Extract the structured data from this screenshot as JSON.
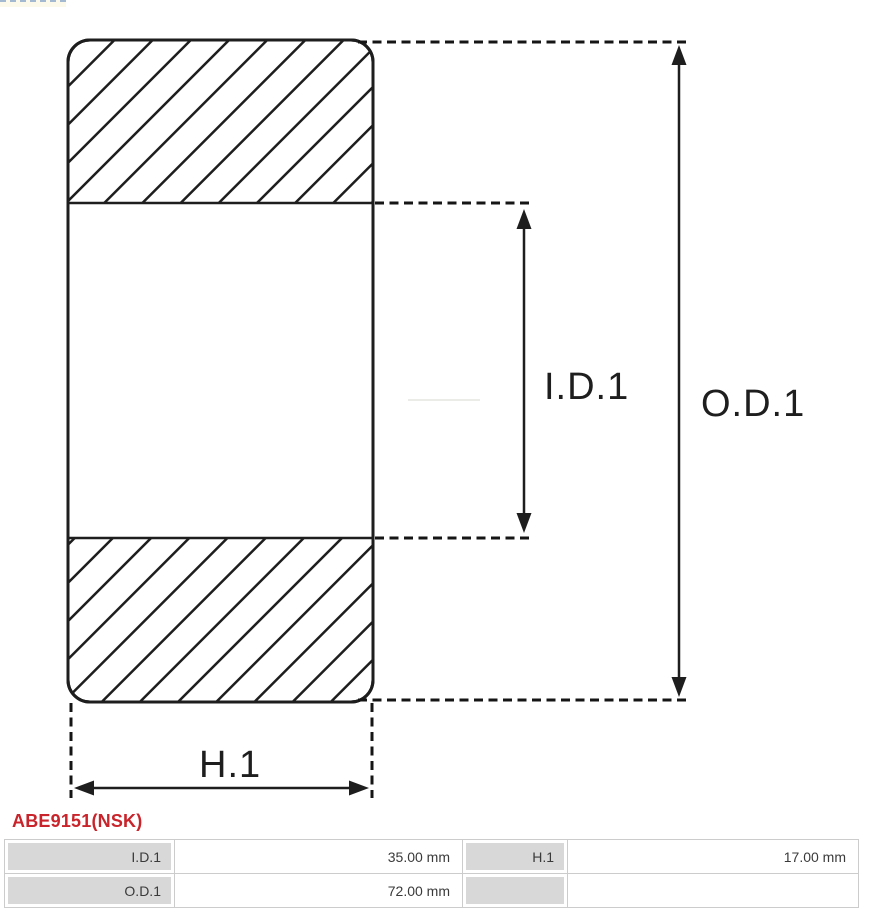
{
  "part": {
    "title": "ABE9151(NSK)"
  },
  "diagram": {
    "labels": {
      "inner_diameter": "I.D.1",
      "outer_diameter": "O.D.1",
      "height": "H.1"
    }
  },
  "specs": {
    "rows": [
      {
        "label1": "I.D.1",
        "value1": "35.00 mm",
        "label2": "H.1",
        "value2": "17.00 mm"
      },
      {
        "label1": "O.D.1",
        "value1": "72.00 mm",
        "label2": "",
        "value2": ""
      }
    ]
  },
  "colors": {
    "accent_red": "#c9242b",
    "line": "#1e1e1e",
    "table_label_bg": "#d8d8d8",
    "table_border": "#cccccc"
  }
}
